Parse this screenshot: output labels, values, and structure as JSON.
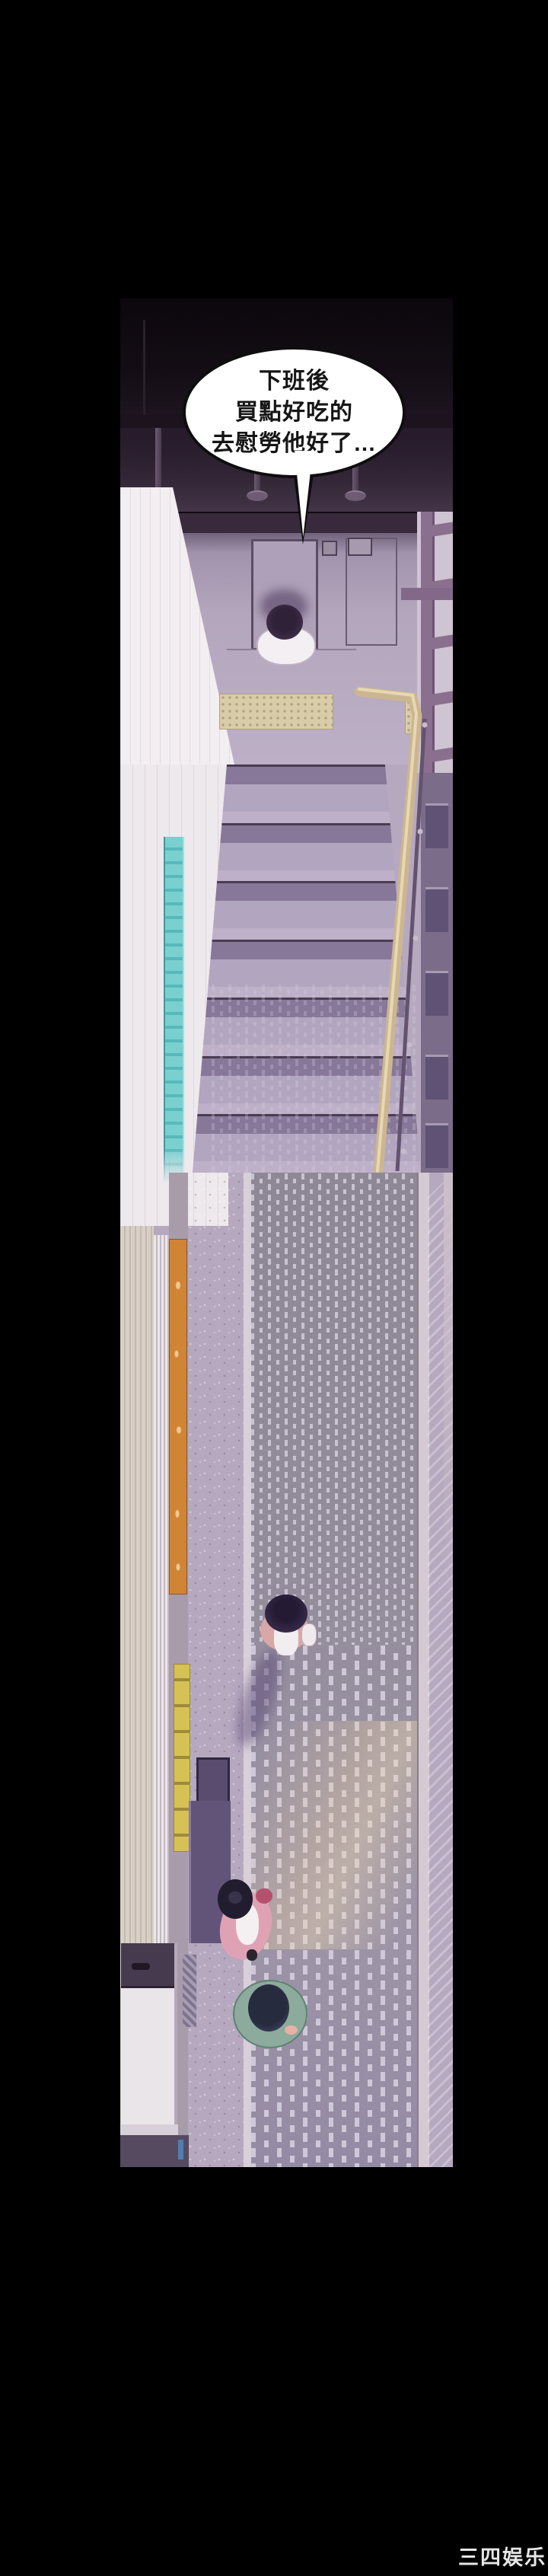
{
  "panel": {
    "description": "overhead stairwell descending to a street crosswalk, three pedestrians",
    "speech_bubble": {
      "lines": [
        "下班後",
        "買點好吃的",
        "去慰勞他好了…"
      ]
    }
  },
  "watermark": {
    "text": "三四娱乐",
    "color": "#e6e6e6"
  },
  "colors": {
    "page_bg": "#000000",
    "ceiling_dark": "#0b070c",
    "beam": "#382a3c",
    "landing_wall": "#b3a6bd",
    "lit_wall": "#f3eef1",
    "tactile_paving": "#d9cda9",
    "handrail_tan": "#ccb690",
    "balustrade_purple": "#8a6f8e",
    "step_tread": "#b2a5bf",
    "teal_window": "#79d0cf",
    "orange_banner": "#d08436",
    "yellow_banner": "#d6c154",
    "road": "#938c9b",
    "crosswalk_dash": "#c9c2d2",
    "pink_sidewalk": "#b07e90",
    "woman1_hair": "#342944",
    "woman1_jacket": "#d8a8a6",
    "woman2_cardigan": "#dfa2b4",
    "man_jacket": "#8cab9c",
    "kiosk_top": "#463a4e"
  }
}
